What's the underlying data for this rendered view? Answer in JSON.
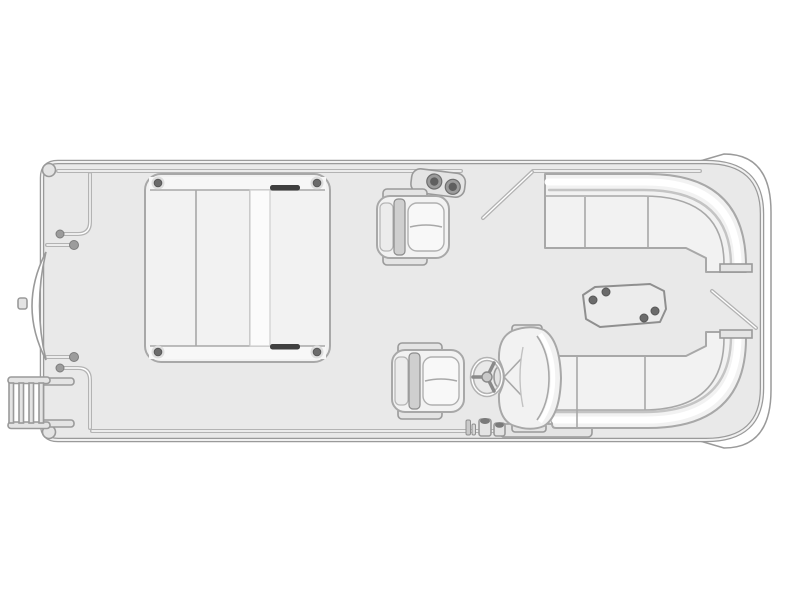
{
  "meta": {
    "title": "Pontoon boat floor plan, top view line diagram"
  },
  "canvas": {
    "background": "#ffffff",
    "deck": "#e9e9e9",
    "outline": "#9a9a9a",
    "rail": "#b3b3b3",
    "cushion": "#f2f2f2",
    "cushion_line": "#a8a8a8",
    "dark": "#6b6b6b",
    "dark_bar": "#3f3f3f",
    "highlight": "#ffffff",
    "table": "#ececec",
    "fitting": "#e4e4e4"
  },
  "parts": {
    "deck": {
      "label": "Pontoon deck with perimeter rail"
    },
    "stern_skin": {
      "label": "Outer stern hull band"
    },
    "bow_ladder": {
      "label": "Bow boarding ladder",
      "rungs": 4
    },
    "bow_gate": {
      "label": "Bow gate shown open"
    },
    "side_gate": {
      "label": "Port side gate shown open"
    },
    "stern_gate": {
      "label": "Stern gate shown open"
    },
    "forward_bench": {
      "label": "Forward lounge bench",
      "corner_screws": 4
    },
    "cup_holders": {
      "label": "Twin rail cup holders",
      "count": 2
    },
    "chair_forward": {
      "label": "Forward swivel captain chair"
    },
    "chair_aft": {
      "label": "Aft swivel captain chair"
    },
    "steering_wheel": {
      "label": "Helm steering wheel"
    },
    "helm_seat": {
      "label": "Captain helm seat"
    },
    "helm_controls": {
      "label": "Throttle and helm controls"
    },
    "stern_couch_top": {
      "label": "Wrap-around stern couch, port side"
    },
    "stern_couch_bottom": {
      "label": "Wrap-around stern couch, starboard side"
    },
    "table": {
      "label": "Cocktail table",
      "mount_screws": 4
    }
  }
}
